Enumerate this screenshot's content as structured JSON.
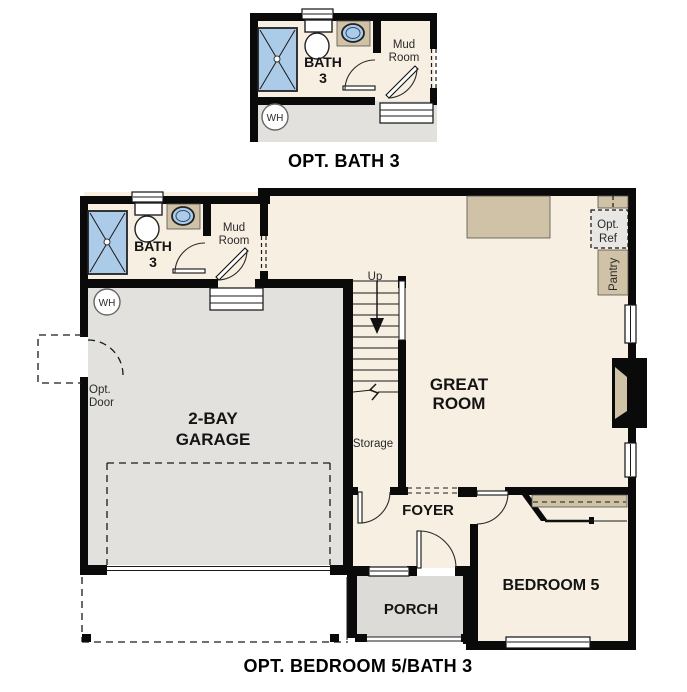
{
  "colors": {
    "wall": "#0a0a0a",
    "floor": "#f7efe1",
    "garage": "#e2e1de",
    "porch": "#dcdbd8",
    "tan": "#cfc2a7",
    "blue": "#abcbe9",
    "optref": "#e8e7e4"
  },
  "inset": {
    "caption": "OPT. BATH 3",
    "bath_label": "BATH",
    "bath_number": "3",
    "mud_room_line1": "Mud",
    "mud_room_line2": "Room",
    "water_heater": "WH"
  },
  "main": {
    "caption": "OPT. BEDROOM 5/BATH 3",
    "bath_label": "BATH",
    "bath_number": "3",
    "mud_room_line1": "Mud",
    "mud_room_line2": "Room",
    "water_heater": "WH",
    "garage_line1": "2-BAY",
    "garage_line2": "GARAGE",
    "opt_door_line1": "Opt.",
    "opt_door_line2": "Door",
    "stairs_up": "Up",
    "storage": "Storage",
    "great_room_line1": "GREAT",
    "great_room_line2": "ROOM",
    "opt_ref_line1": "Opt.",
    "opt_ref_line2": "Ref",
    "pantry": "Pantry",
    "foyer": "FOYER",
    "porch": "PORCH",
    "bedroom": "BEDROOM 5"
  }
}
